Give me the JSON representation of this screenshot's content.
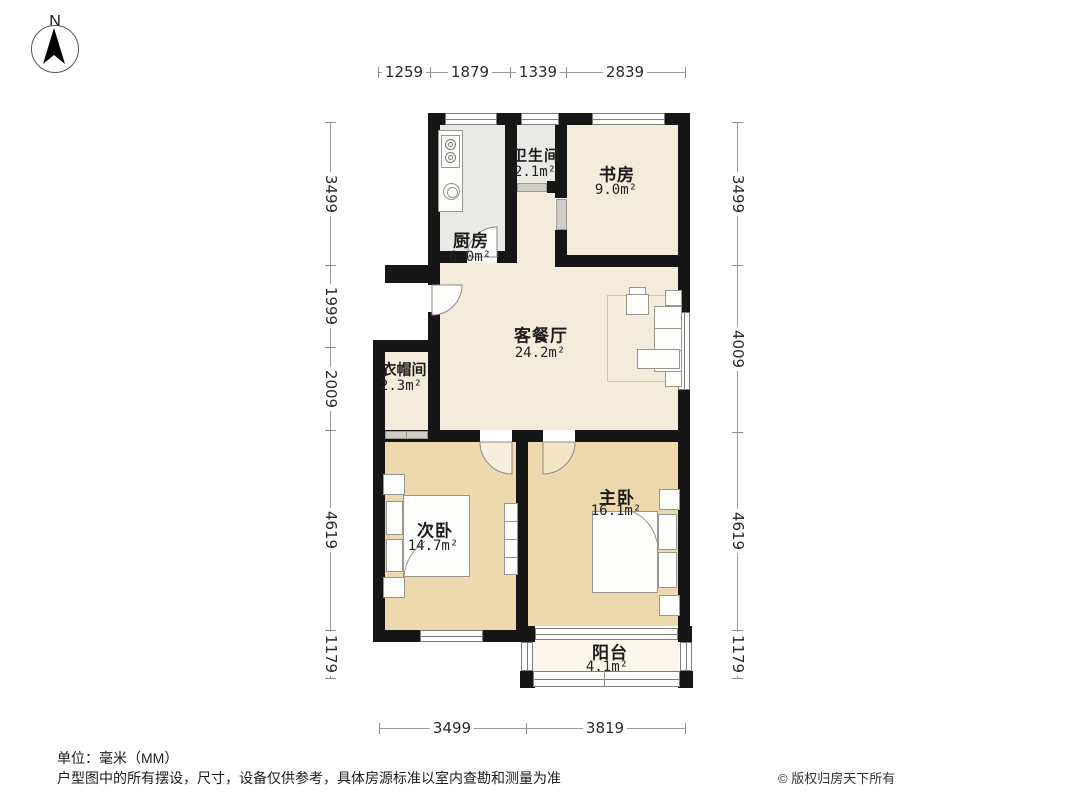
{
  "compass": {
    "label": "N"
  },
  "rooms": {
    "kitchen": {
      "name": "厨房",
      "area": "6.0m²"
    },
    "bathroom": {
      "name": "卫生间",
      "area": "2.1m²"
    },
    "study": {
      "name": "书房",
      "area": "9.0m²"
    },
    "living": {
      "name": "客餐厅",
      "area": "24.2m²"
    },
    "cloakroom": {
      "name": "衣帽间",
      "area": "2.3m²"
    },
    "secondary": {
      "name": "次卧",
      "area": "14.7m²"
    },
    "master": {
      "name": "主卧",
      "area": "16.1m²"
    },
    "balcony": {
      "name": "阳台",
      "area": "4.1m²"
    }
  },
  "dimensions": {
    "top": [
      "1259",
      "1879",
      "1339",
      "2839"
    ],
    "left": [
      "3499",
      "1999",
      "2009",
      "4619",
      "1179"
    ],
    "right": [
      "3499",
      "4009",
      "4619",
      "1179"
    ],
    "bottom": [
      "3499",
      "3819"
    ]
  },
  "footer": {
    "unit": "单位：毫米（MM）",
    "disclaimer": "户型图中的所有摆设，尺寸，设备仅供参考，具体房源标准以室内查勘和测量为准",
    "copyright": "© 版权归房天下所有"
  },
  "icons": {
    "compass": "north-arrow",
    "kitchen": [
      "stove-icon",
      "sink-icon"
    ],
    "living": [
      "sofa-icon",
      "armchair-icon",
      "coffee-table-icon",
      "side-table-icon"
    ],
    "bedrooms": [
      "bed-icon",
      "pillow-icon",
      "nightstand-icon",
      "wardrobe-icon"
    ]
  },
  "colors": {
    "wall": "#161616",
    "floor_living": "#f4ecda",
    "floor_kitchen_bath": "#e9e9e5",
    "floor_bedroom": "#eed9ae",
    "floor_balcony": "#faf6ea"
  }
}
